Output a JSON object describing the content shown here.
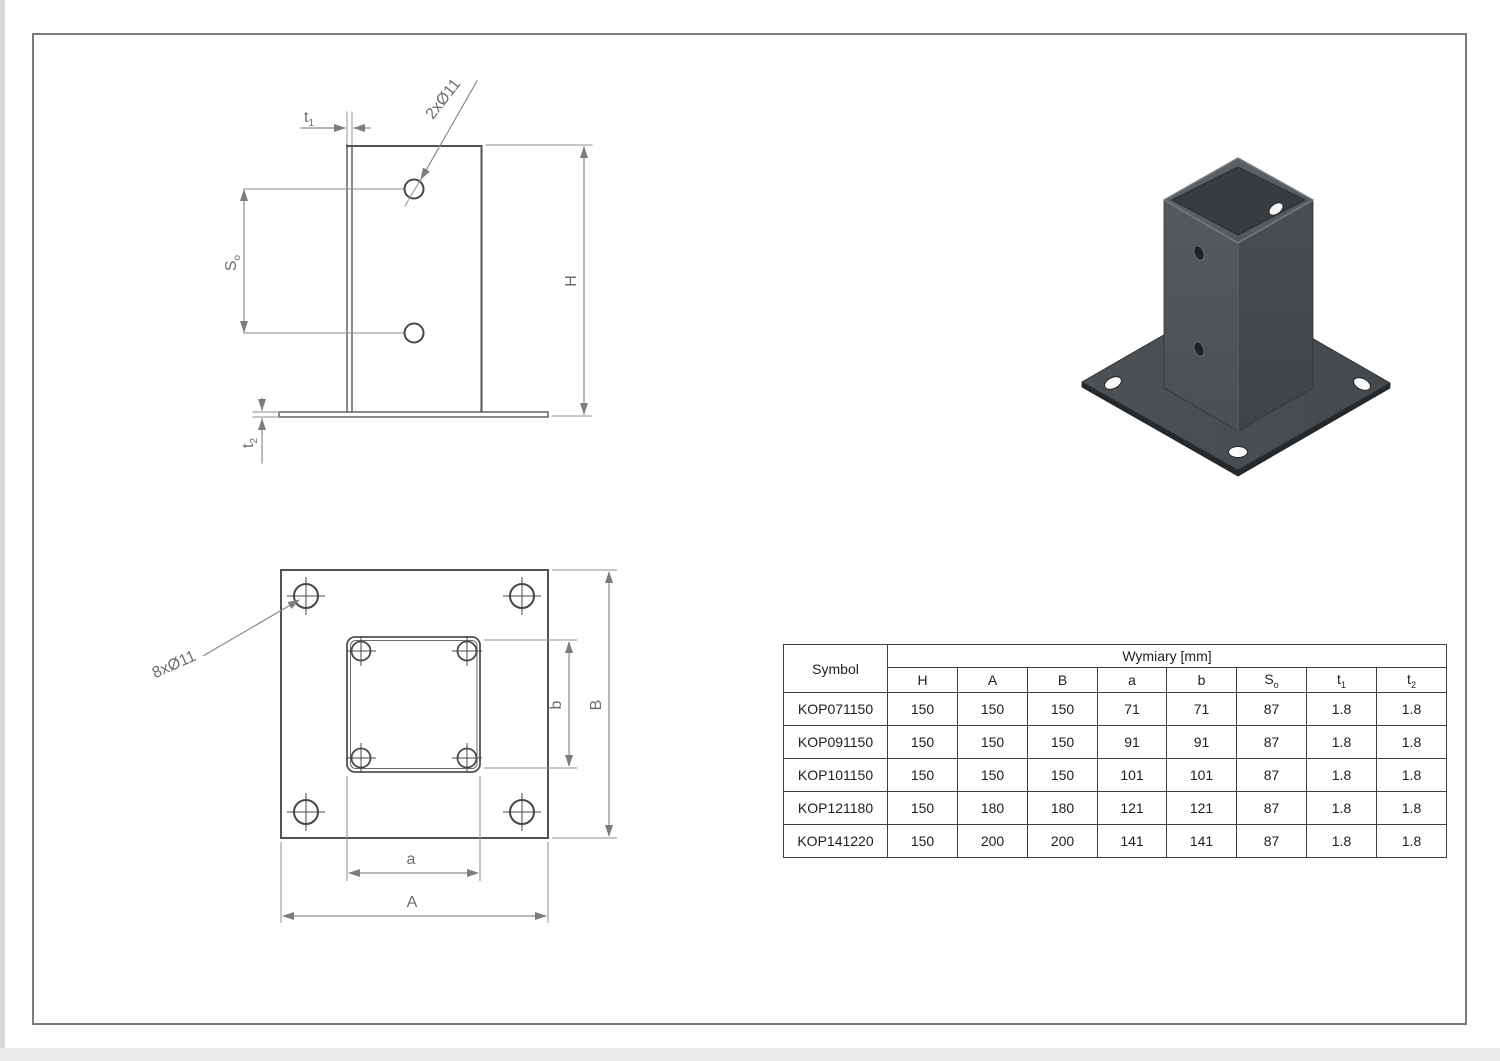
{
  "side_view": {
    "hole_callout": "2xØ11",
    "labels": {
      "t1": {
        "base": "t",
        "sub": "1"
      },
      "t2": {
        "base": "t",
        "sub": "2"
      },
      "So": {
        "base": "S",
        "sub": "o"
      },
      "H": "H"
    }
  },
  "top_view": {
    "hole_callout": "8xØ11",
    "labels": {
      "a": "a",
      "A": "A",
      "b": "b",
      "B": "B"
    }
  },
  "table": {
    "symbol_header": "Symbol",
    "group_header": "Wymiary  [mm]",
    "columns": [
      {
        "base": "H",
        "sub": ""
      },
      {
        "base": "A",
        "sub": ""
      },
      {
        "base": "B",
        "sub": ""
      },
      {
        "base": "a",
        "sub": ""
      },
      {
        "base": "b",
        "sub": ""
      },
      {
        "base": "S",
        "sub": "o"
      },
      {
        "base": "t",
        "sub": "1"
      },
      {
        "base": "t",
        "sub": "2"
      }
    ],
    "rows": [
      {
        "symbol": "KOP071150",
        "values": [
          "150",
          "150",
          "150",
          "71",
          "71",
          "87",
          "1.8",
          "1.8"
        ]
      },
      {
        "symbol": "KOP091150",
        "values": [
          "150",
          "150",
          "150",
          "91",
          "91",
          "87",
          "1.8",
          "1.8"
        ]
      },
      {
        "symbol": "KOP101150",
        "values": [
          "150",
          "150",
          "150",
          "101",
          "101",
          "87",
          "1.8",
          "1.8"
        ]
      },
      {
        "symbol": "KOP121180",
        "values": [
          "150",
          "180",
          "180",
          "121",
          "121",
          "87",
          "1.8",
          "1.8"
        ]
      },
      {
        "symbol": "KOP141220",
        "values": [
          "150",
          "200",
          "200",
          "141",
          "141",
          "87",
          "1.8",
          "1.8"
        ]
      }
    ]
  },
  "colors": {
    "object_line": "#55585b",
    "dimension_line": "#8c8c8c",
    "table_border": "#3e3e3e",
    "metal_dark": "#46494d",
    "metal_light": "#54585b"
  }
}
